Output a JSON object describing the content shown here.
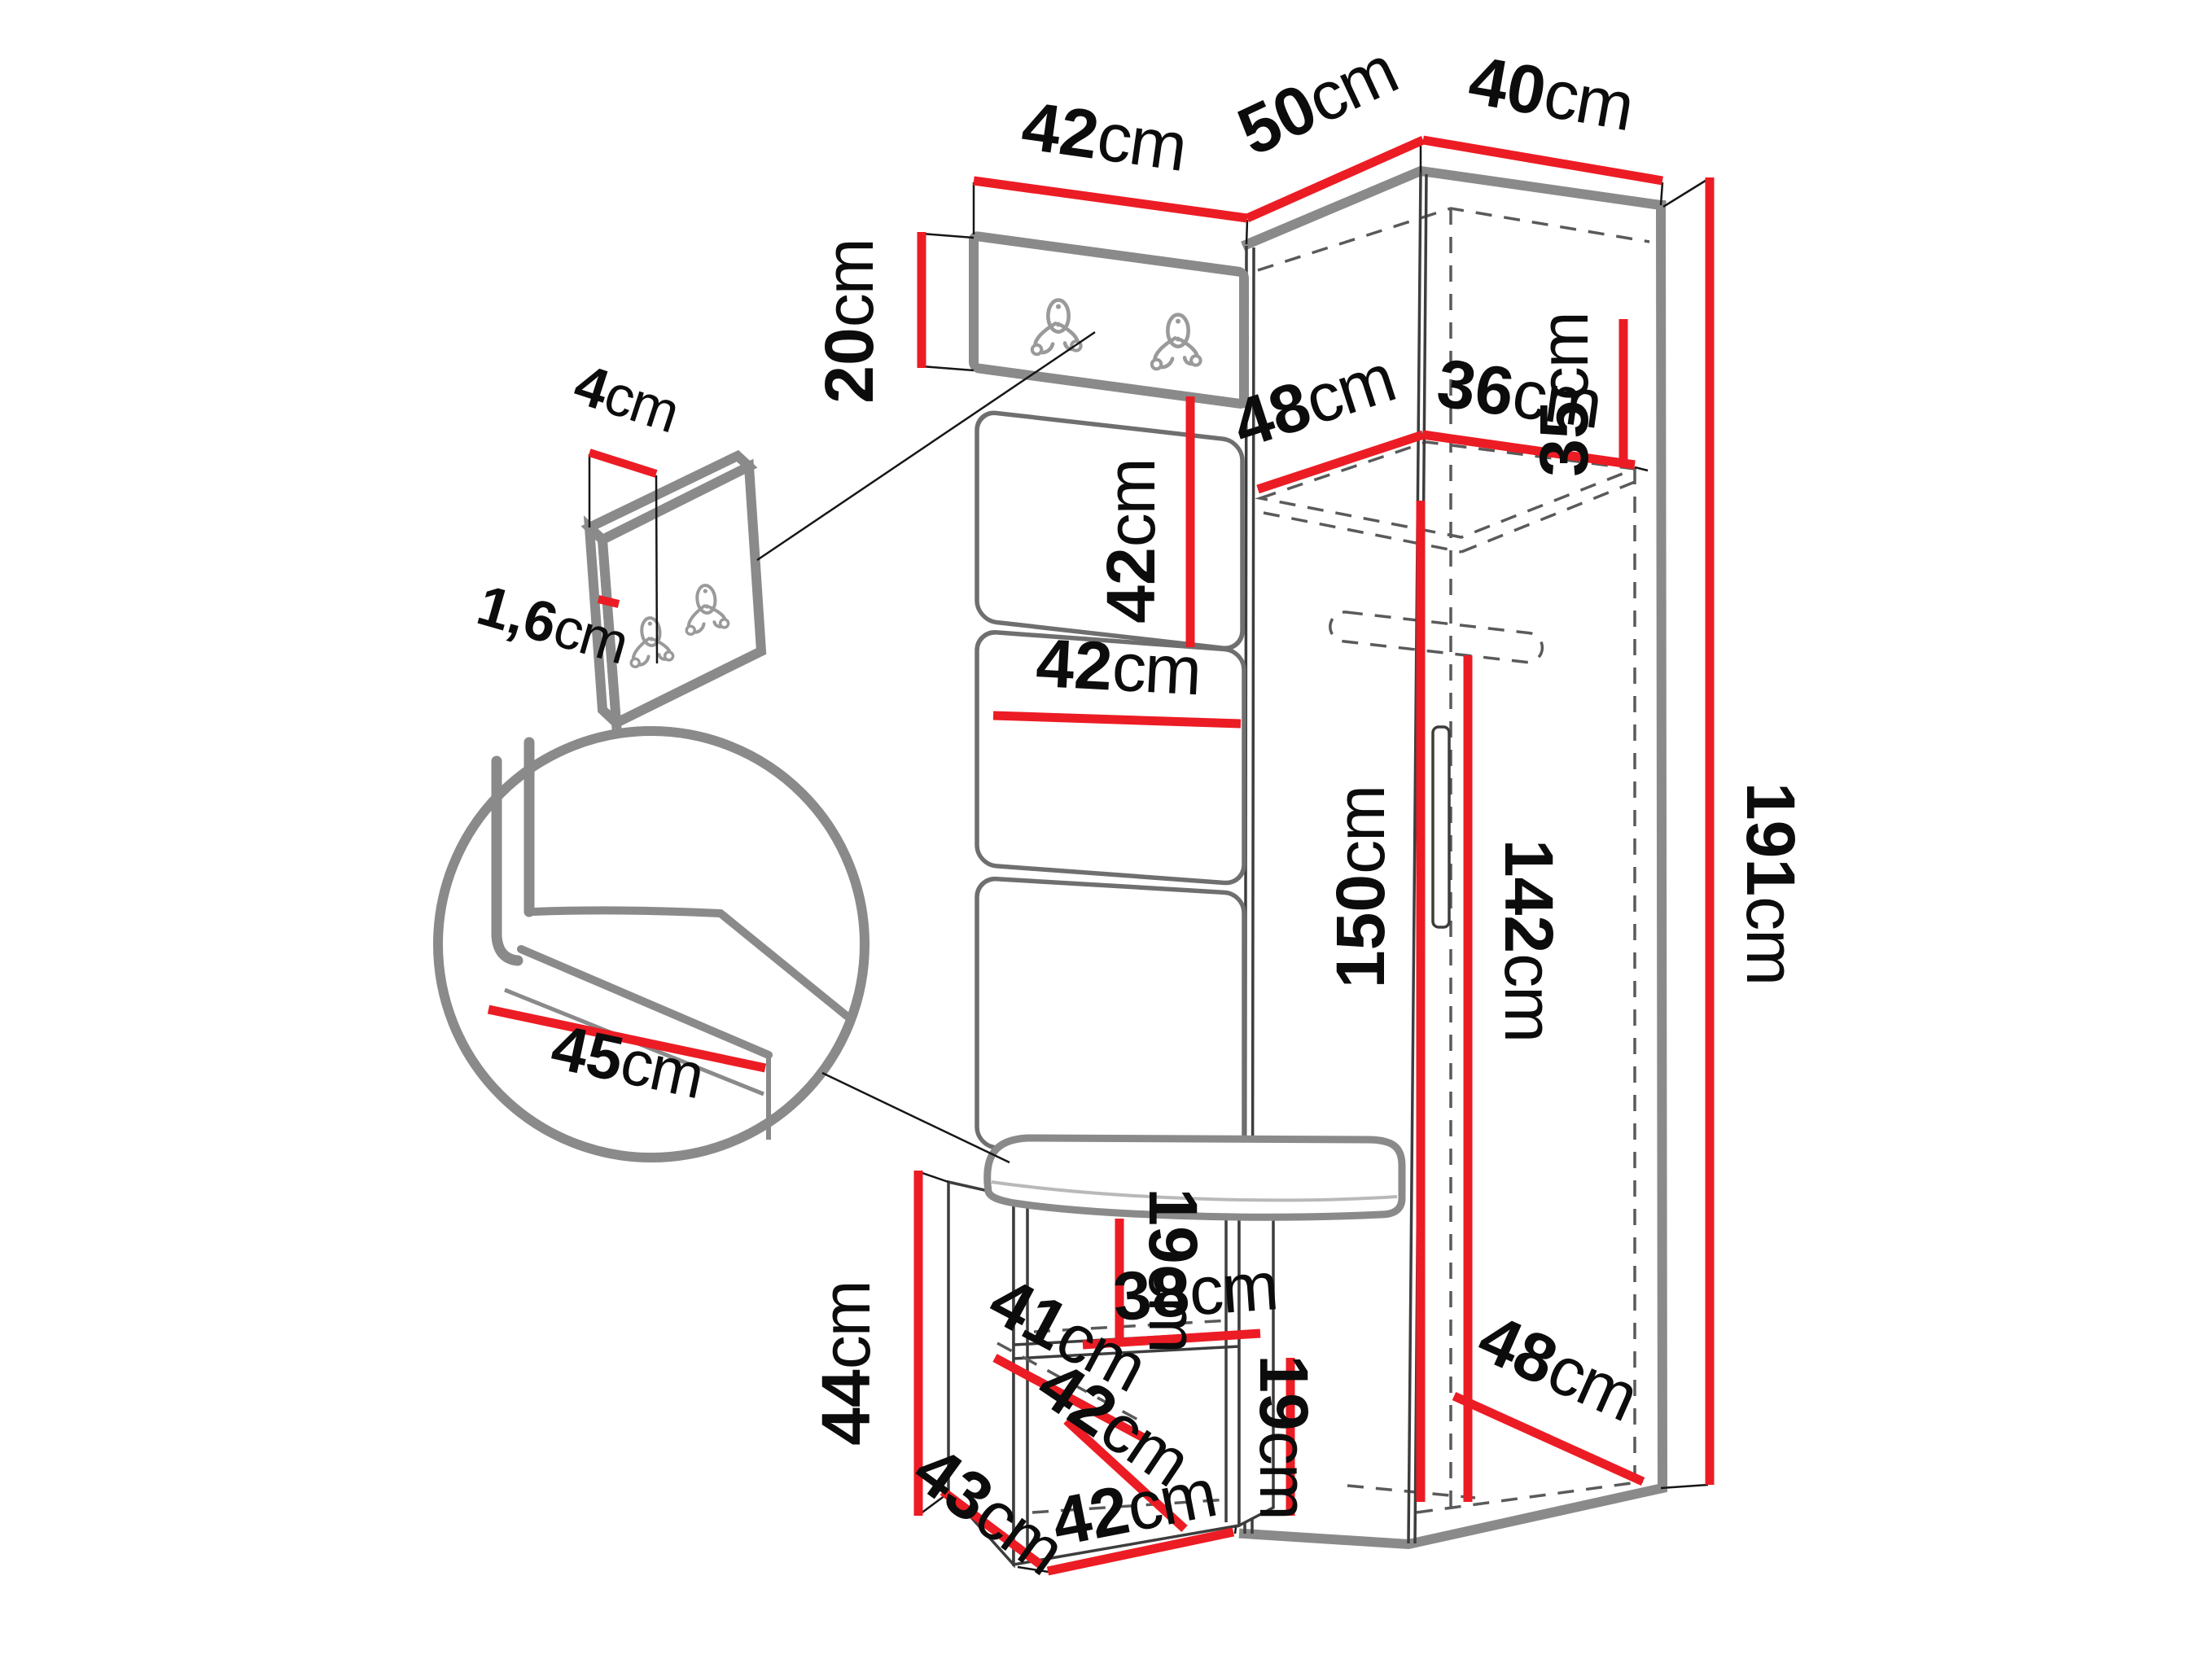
{
  "diagram": {
    "type": "furniture-dimension-diagram",
    "subject": "corner hallway wardrobe set with hook panel, padded wall panels, shoe bench and corner cabinet",
    "unit_suffix": "cm"
  },
  "colors": {
    "dimension_red": "#EC1C24",
    "outline_gray": "#8A8A8A",
    "panel_gray": "#6F6F6F",
    "dashed_gray": "#5A5A5A",
    "text_black": "#0C0C0C",
    "background": "#FFFFFF"
  },
  "icons": {
    "hook": "double-coat-hook-icon",
    "rod": "hanging-rod-outline"
  },
  "dims": {
    "top_width_left": {
      "num": "42",
      "unit": "cm"
    },
    "top_width_mid": {
      "num": "50",
      "unit": "cm"
    },
    "top_width_right": {
      "num": "40",
      "unit": "cm"
    },
    "hook_panel_height": {
      "num": "20",
      "unit": "cm"
    },
    "panel_height_upper": {
      "num": "42",
      "unit": "cm"
    },
    "shelf_depth": {
      "num": "48",
      "unit": "cm"
    },
    "shelf_width": {
      "num": "36",
      "unit": "cm"
    },
    "top_compartment_height": {
      "num": "35",
      "unit": "cm"
    },
    "total_height": {
      "num": "191",
      "unit": "cm"
    },
    "panel_width": {
      "num": "42",
      "unit": "cm"
    },
    "interior_height": {
      "num": "150",
      "unit": "cm"
    },
    "rod_height": {
      "num": "142",
      "unit": "cm"
    },
    "detail_width": {
      "num": "4",
      "unit": "cm"
    },
    "detail_thickness": {
      "num": "1,6",
      "unit": "cm"
    },
    "seat_depth": {
      "num": "45",
      "unit": "cm"
    },
    "bench_height": {
      "num": "44",
      "unit": "cm"
    },
    "bench_depth_top": {
      "num": "41",
      "unit": "cm"
    },
    "cubby_height_upper": {
      "num": "19",
      "unit": "cm"
    },
    "bench_shelf_width": {
      "num": "38",
      "unit": "cm"
    },
    "bench_depth_lower": {
      "num": "42",
      "unit": "cm"
    },
    "cubby_height_lower": {
      "num": "19",
      "unit": "cm"
    },
    "bench_side_depth": {
      "num": "43",
      "unit": "cm"
    },
    "bench_width": {
      "num": "42",
      "unit": "cm"
    },
    "floor_depth": {
      "num": "48",
      "unit": "cm"
    }
  }
}
